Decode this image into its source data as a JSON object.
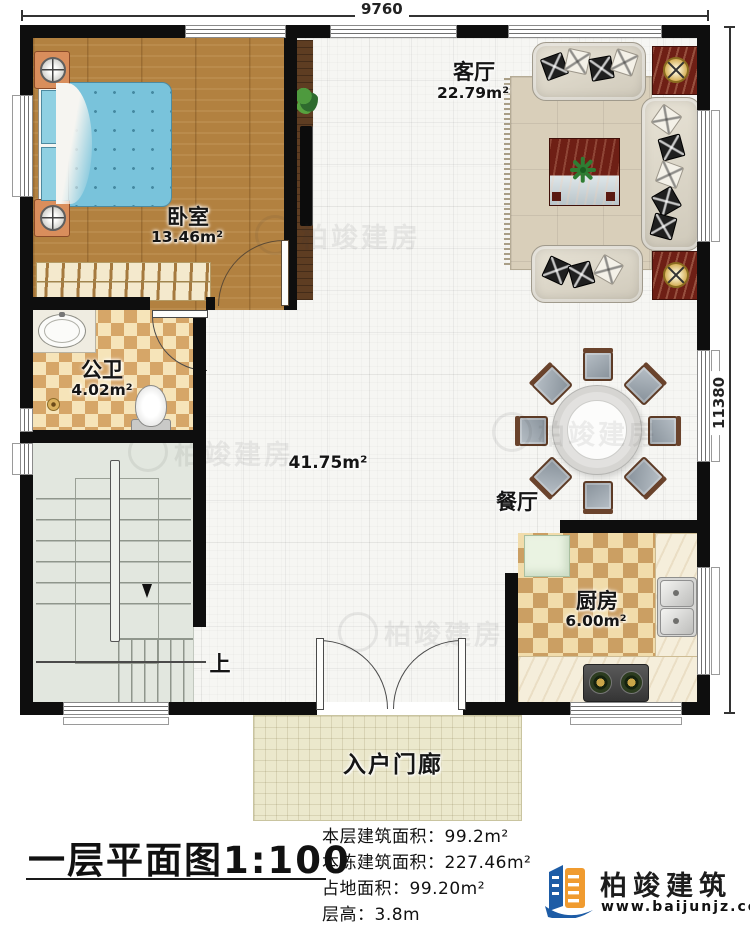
{
  "dimensions": {
    "width_label": "9760",
    "height_label": "11380"
  },
  "rooms": {
    "living": {
      "name": "客厅",
      "area": "22.79m²"
    },
    "bedroom": {
      "name": "卧室",
      "area": "13.46m²"
    },
    "bathroom": {
      "name": "公卫",
      "area": "4.02m²"
    },
    "hall": {
      "area": "41.75m²"
    },
    "dining": {
      "name": "餐厅"
    },
    "kitchen": {
      "name": "厨房",
      "area": "6.00m²"
    },
    "porch": {
      "name": "入户门廊"
    },
    "stairs": {
      "direction_label": "上"
    }
  },
  "title_block": {
    "title": "一层平面图",
    "scale": "1:100",
    "colon": "：",
    "stats": [
      {
        "label": "本层建筑面积",
        "value": "99.2m²"
      },
      {
        "label": "本栋建筑面积",
        "value": "227.46m²"
      },
      {
        "label": "占地面积",
        "value": "99.20m²"
      },
      {
        "label": "层高",
        "value": "3.8m"
      }
    ]
  },
  "brand": {
    "name": "柏竣建筑",
    "website": "www.baijunjz.com"
  },
  "watermark": {
    "text": "柏竣建房"
  },
  "colors": {
    "wall": "#0e0e0e",
    "wood_floor": "#b28140",
    "bed_blue": "#79c3db",
    "panel_red": "#6e1f15",
    "brand_blue": "#1d5ca6",
    "brand_orange": "#f09b2f"
  }
}
